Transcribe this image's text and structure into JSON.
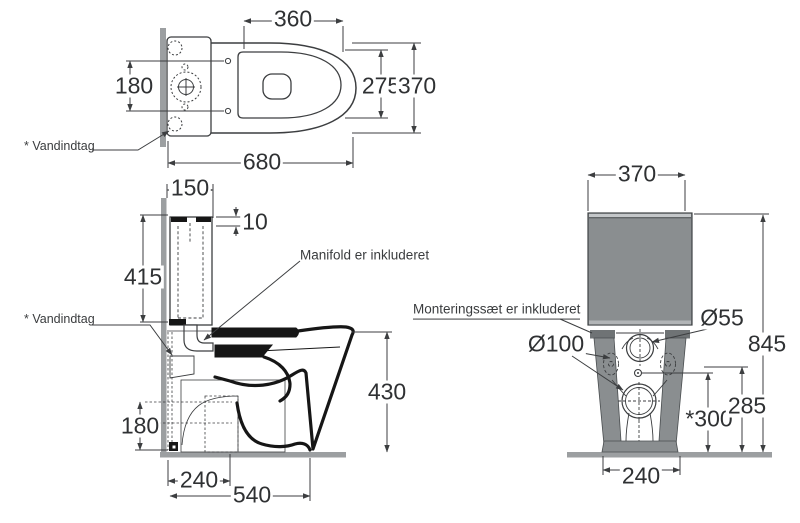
{
  "drawing_title": "Toilet technical dimension drawing (3 views)",
  "colors": {
    "line_thin": "#3c3e40",
    "line_thick": "#161616",
    "wall_gray": "#9c9fa1",
    "floor_gray": "#9c9fa1",
    "tank_gray": "#8a8e90",
    "leg_gray": "#6f7375",
    "band_light": "#c4c7c9",
    "text": "#2f3133"
  },
  "annotations": {
    "vandindtag_top": "* Vandindtag",
    "vandindtag_side": "* Vandindtag",
    "manifold": "Manifold er inkluderet",
    "mounting": "Monteringssæt er inkluderet"
  },
  "top_view": {
    "dims": {
      "seat_length": "360",
      "inlet_spacing": "180",
      "seat_width": "275",
      "bowl_width": "370",
      "total_depth": "680"
    }
  },
  "side_view": {
    "dims": {
      "tank_depth": "150",
      "lid_height": "10",
      "tank_height": "415",
      "rim_height": "430",
      "outlet_height": "180",
      "outlet_distance": "240",
      "total_depth": "540"
    }
  },
  "front_view": {
    "dims": {
      "tank_width": "370",
      "small_hole_diameter": "Ø55",
      "large_hole_diameter": "Ø100",
      "total_height": "845",
      "marked_height": "*300",
      "bracket_height": "285",
      "base_width": "240"
    }
  }
}
